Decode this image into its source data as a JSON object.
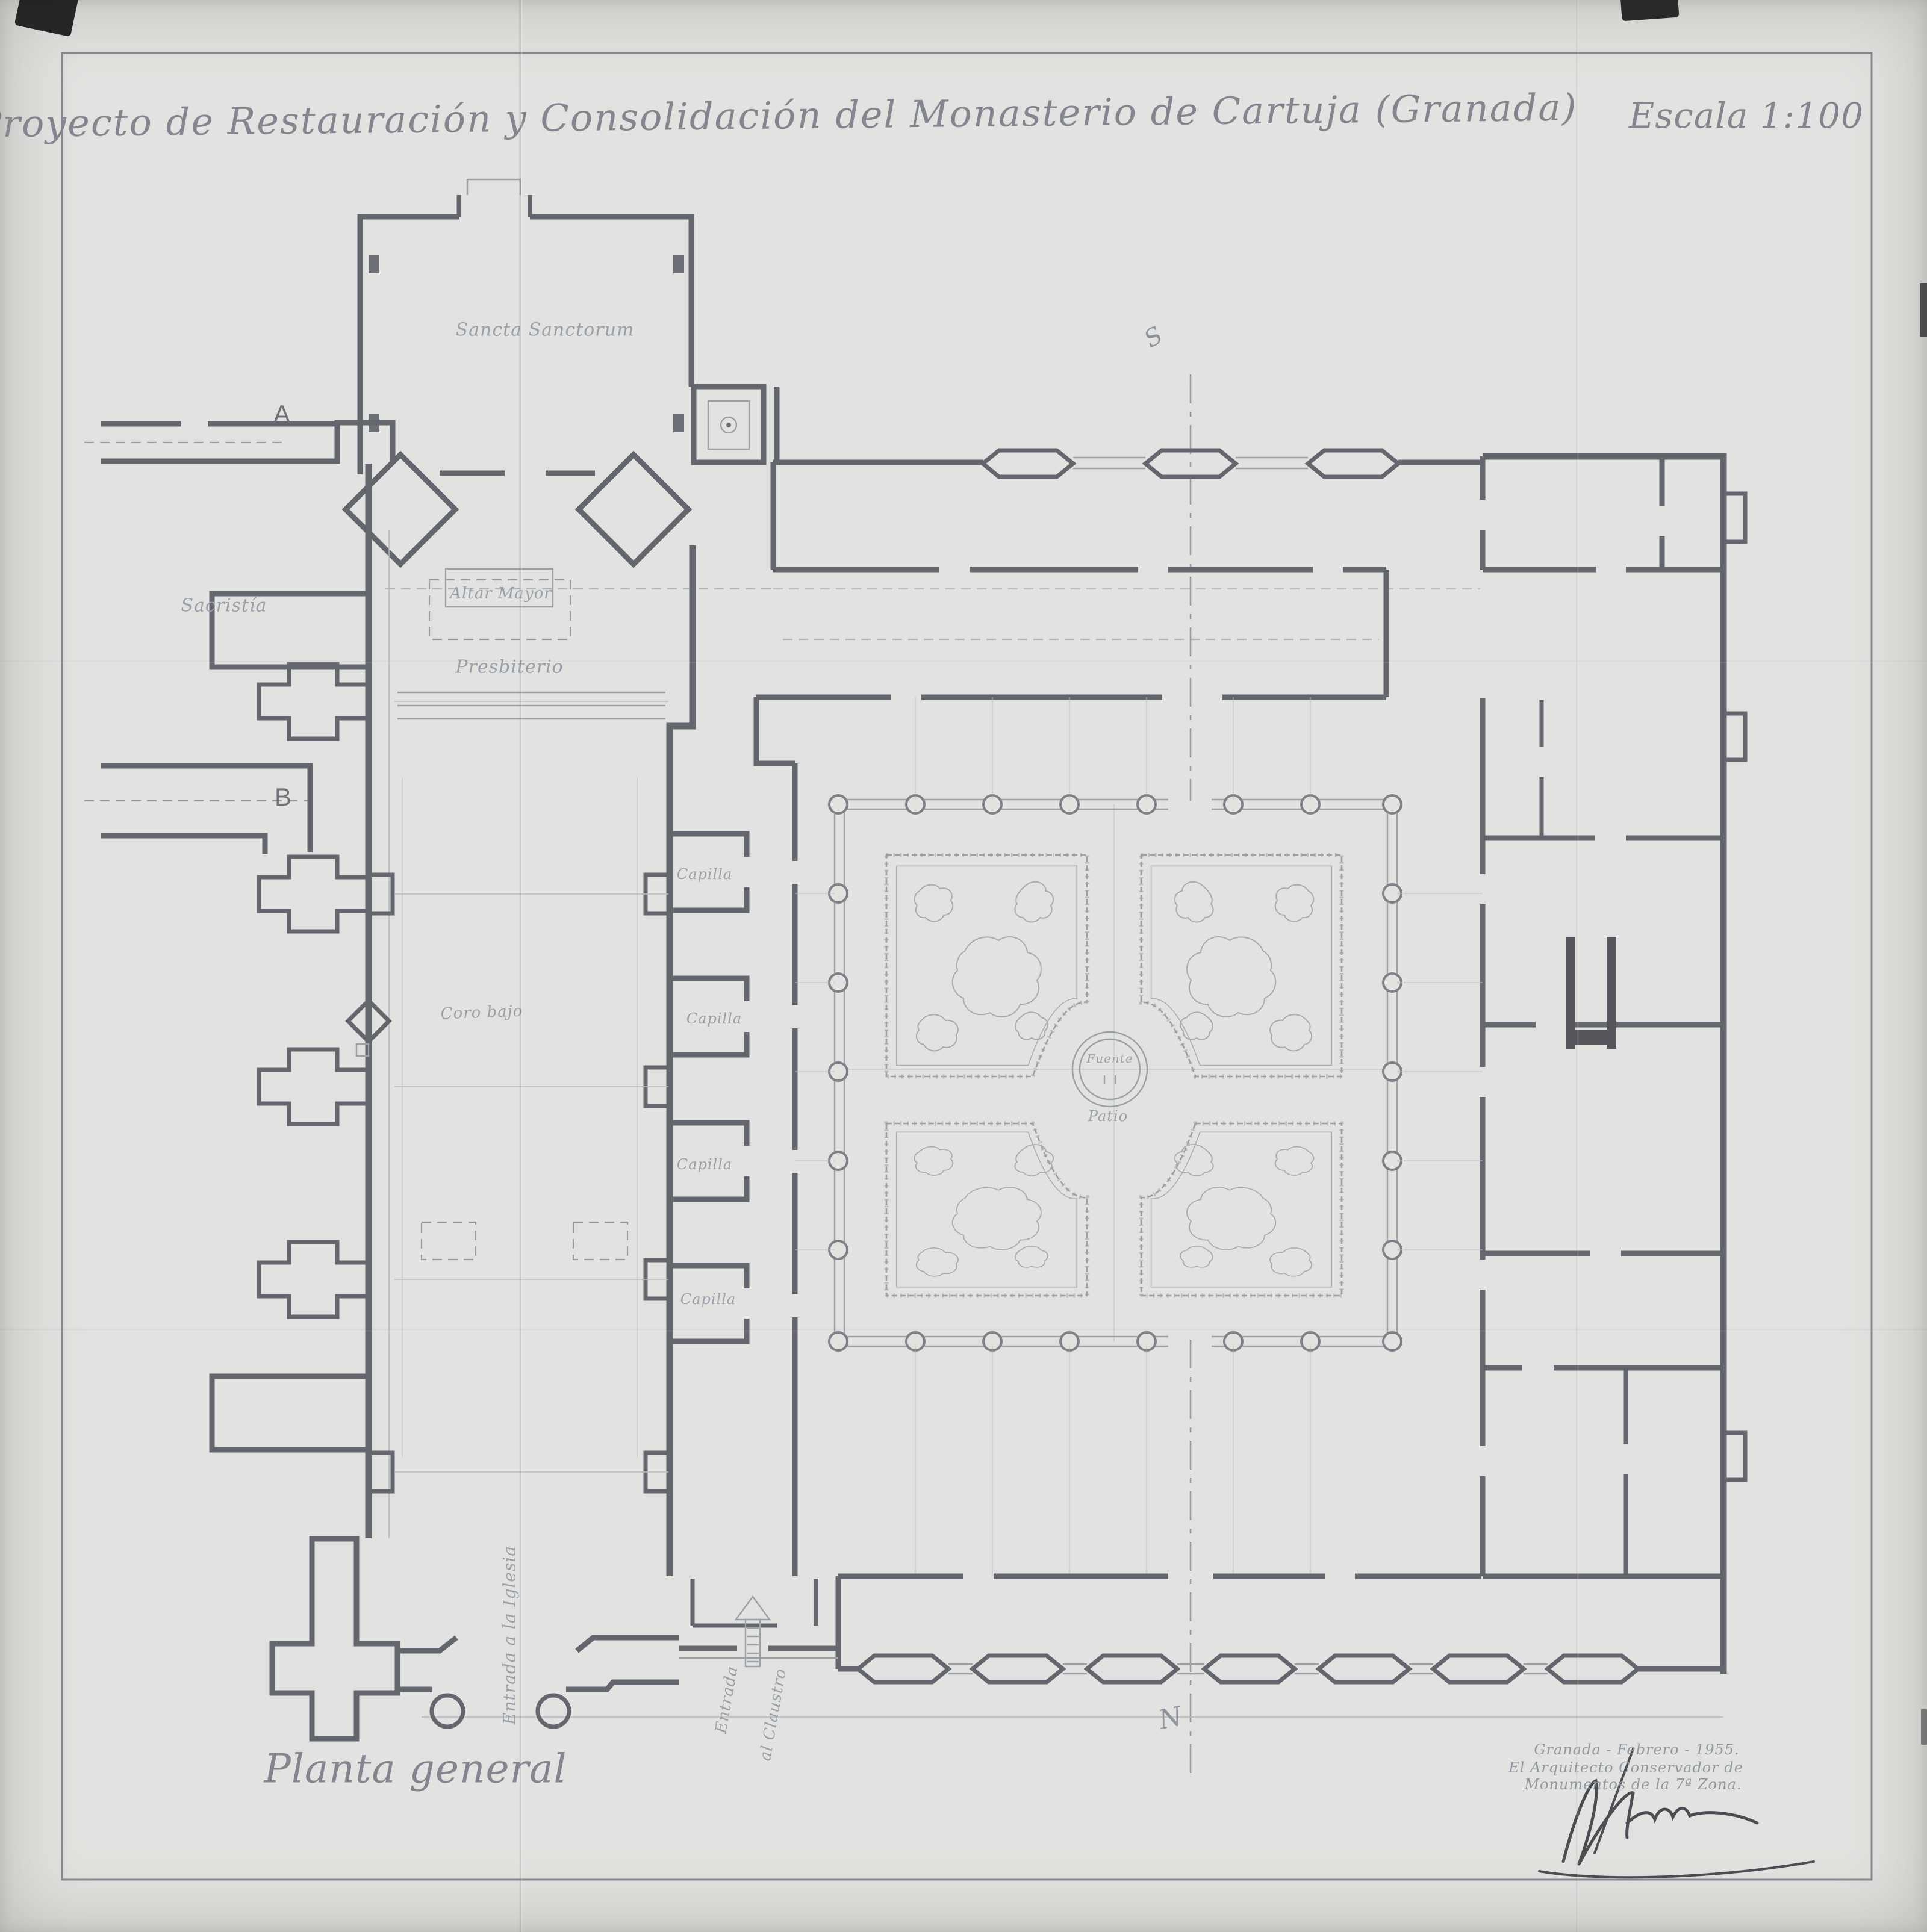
{
  "sheet": {
    "title": "Proyecto de Restauración y Consolidación del Monasterio de Cartuja (Granada)",
    "scale": "Escala 1:100",
    "plan_name": "Planta general"
  },
  "rooms": {
    "sancta_sanctorum": "Sancta Sanctorum",
    "sacristia": "Sacristía",
    "altar_mayor": "Altar Mayor",
    "presbiterio": "Presbiterio",
    "coro": "Coro bajo",
    "capillas": [
      "Capilla",
      "Capilla",
      "Capilla",
      "Capilla"
    ],
    "fuente": "Fuente",
    "patio": "Patio"
  },
  "annotations": {
    "section_a": "A",
    "section_b": "B",
    "axis_mark_top": "S",
    "axis_mark_bottom": "N",
    "entrada_iglesia": "Entrada a la Iglesia",
    "entrada_claustro_line1": "Entrada",
    "entrada_claustro_line2": "al Claustro"
  },
  "signature": {
    "line1": "Granada - Febrero - 1955.",
    "line2": "El Arquitecto Conservador de",
    "line3": "Monumentos de la 7ª Zona."
  },
  "colors": {
    "paper": "#e2e3e0",
    "wall_ink": "#63656b",
    "faint_ink": "#9aa0a7",
    "label_ink": "#959aa4"
  }
}
